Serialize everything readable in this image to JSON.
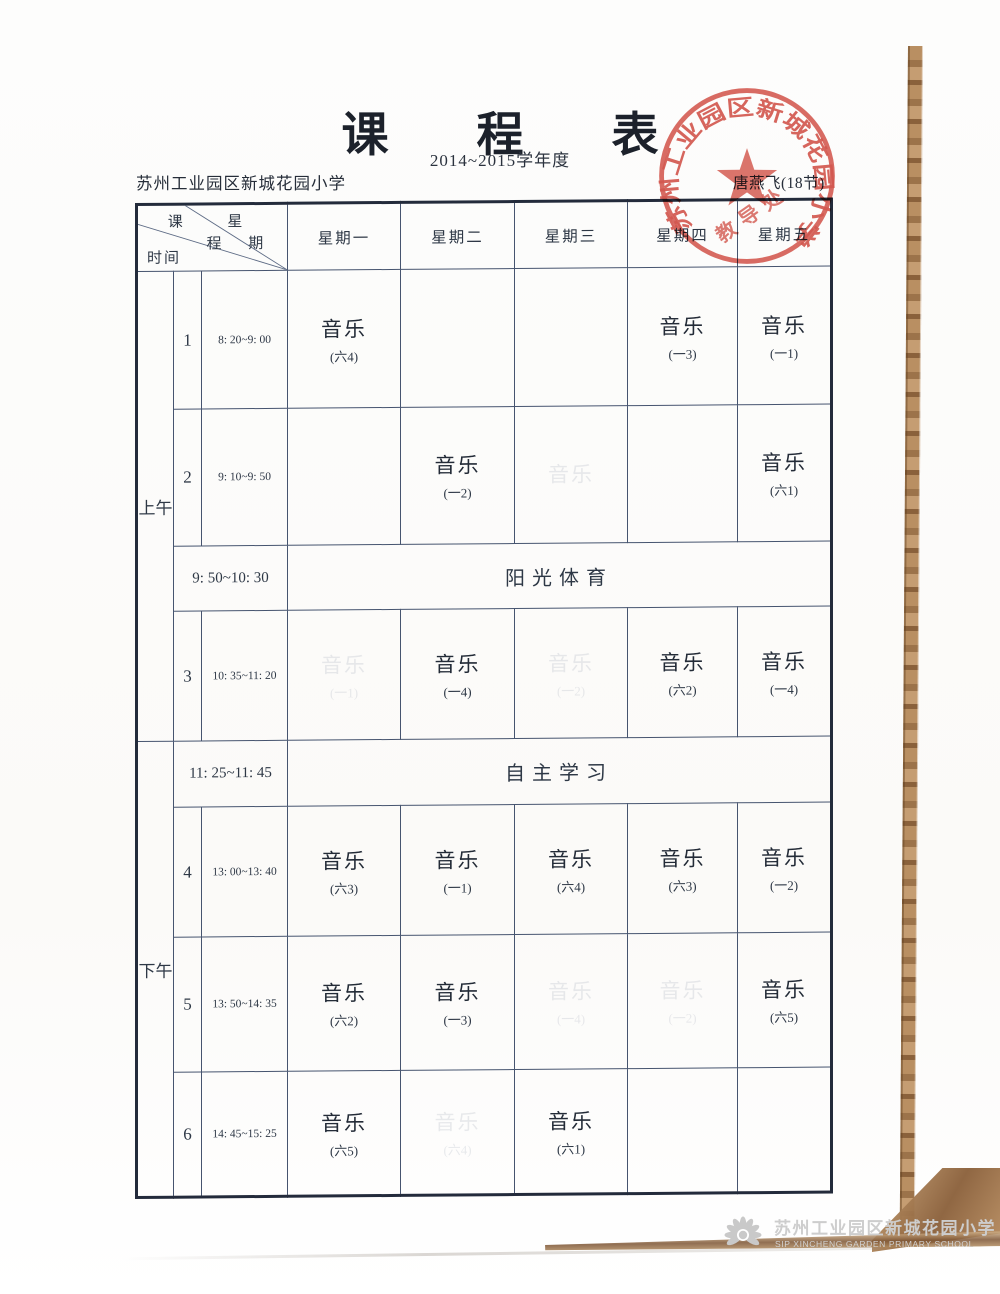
{
  "page": {
    "title": "课程表",
    "subtitle": "2014~2015学年度",
    "school_name": "苏州工业园区新城花园小学",
    "teacher": "唐燕飞(18节)"
  },
  "colors": {
    "stamp_red": "#d0453b",
    "ink": "#2e3846",
    "table_border_blue": "#46546f",
    "watermark_gray": "#cccccc"
  },
  "stamp": {
    "ring_text": "苏州工业园区新城花园小学",
    "inner_text": "教导处"
  },
  "timetable": {
    "corner": {
      "c1": "课",
      "c2": "程",
      "w1": "星",
      "w2": "期",
      "time_label": "时间"
    },
    "days": [
      "星期一",
      "星期二",
      "星期三",
      "星期四",
      "星期五"
    ],
    "sessions": {
      "morning": "上午",
      "afternoon": "下午"
    },
    "rows": [
      {
        "period": "1",
        "time": "8: 20~9: 00",
        "cells": [
          {
            "subject": "音乐",
            "group": "(六4)"
          },
          null,
          null,
          {
            "subject": "音乐",
            "group": "(一3)"
          },
          {
            "subject": "音乐",
            "group": "(一1)"
          }
        ]
      },
      {
        "period": "2",
        "time": "9: 10~9: 50",
        "cells": [
          null,
          {
            "subject": "音乐",
            "group": "(一2)"
          },
          {
            "subject": "音乐",
            "group": "",
            "ghost": true
          },
          null,
          {
            "subject": "音乐",
            "group": "(六1)"
          }
        ]
      },
      {
        "time": "9: 50~10: 30",
        "label": "阳光体育"
      },
      {
        "period": "3",
        "time": "10: 35~11: 20",
        "cells": [
          {
            "subject": "音乐",
            "group": "(一1)",
            "ghost": true
          },
          {
            "subject": "音乐",
            "group": "(一4)"
          },
          {
            "subject": "音乐",
            "group": "(一2)",
            "ghost": true
          },
          {
            "subject": "音乐",
            "group": "(六2)"
          },
          {
            "subject": "音乐",
            "group": "(一4)"
          }
        ]
      },
      {
        "time": "11: 25~11: 45",
        "label": "自主学习"
      },
      {
        "period": "4",
        "time": "13: 00~13: 40",
        "cells": [
          {
            "subject": "音乐",
            "group": "(六3)"
          },
          {
            "subject": "音乐",
            "group": "(一1)"
          },
          {
            "subject": "音乐",
            "group": "(六4)"
          },
          {
            "subject": "音乐",
            "group": "(六3)"
          },
          {
            "subject": "音乐",
            "group": "(一2)"
          }
        ]
      },
      {
        "period": "5",
        "time": "13: 50~14: 35",
        "cells": [
          {
            "subject": "音乐",
            "group": "(六2)"
          },
          {
            "subject": "音乐",
            "group": "(一3)"
          },
          {
            "subject": "音乐",
            "group": "(一4)",
            "ghost": true
          },
          {
            "subject": "音乐",
            "group": "(一2)",
            "ghost": true
          },
          {
            "subject": "音乐",
            "group": "(六5)"
          }
        ]
      },
      {
        "period": "6",
        "time": "14: 45~15: 25",
        "cells": [
          {
            "subject": "音乐",
            "group": "(六5)"
          },
          {
            "subject": "音乐",
            "group": "(六4)",
            "ghost": true
          },
          {
            "subject": "音乐",
            "group": "(六1)"
          },
          null,
          null
        ]
      }
    ]
  },
  "footer": {
    "school_cn": "苏州工业园区新城花园小学",
    "school_en": "SIP XINCHENG GARDEN PRIMARY SCHOOL"
  }
}
